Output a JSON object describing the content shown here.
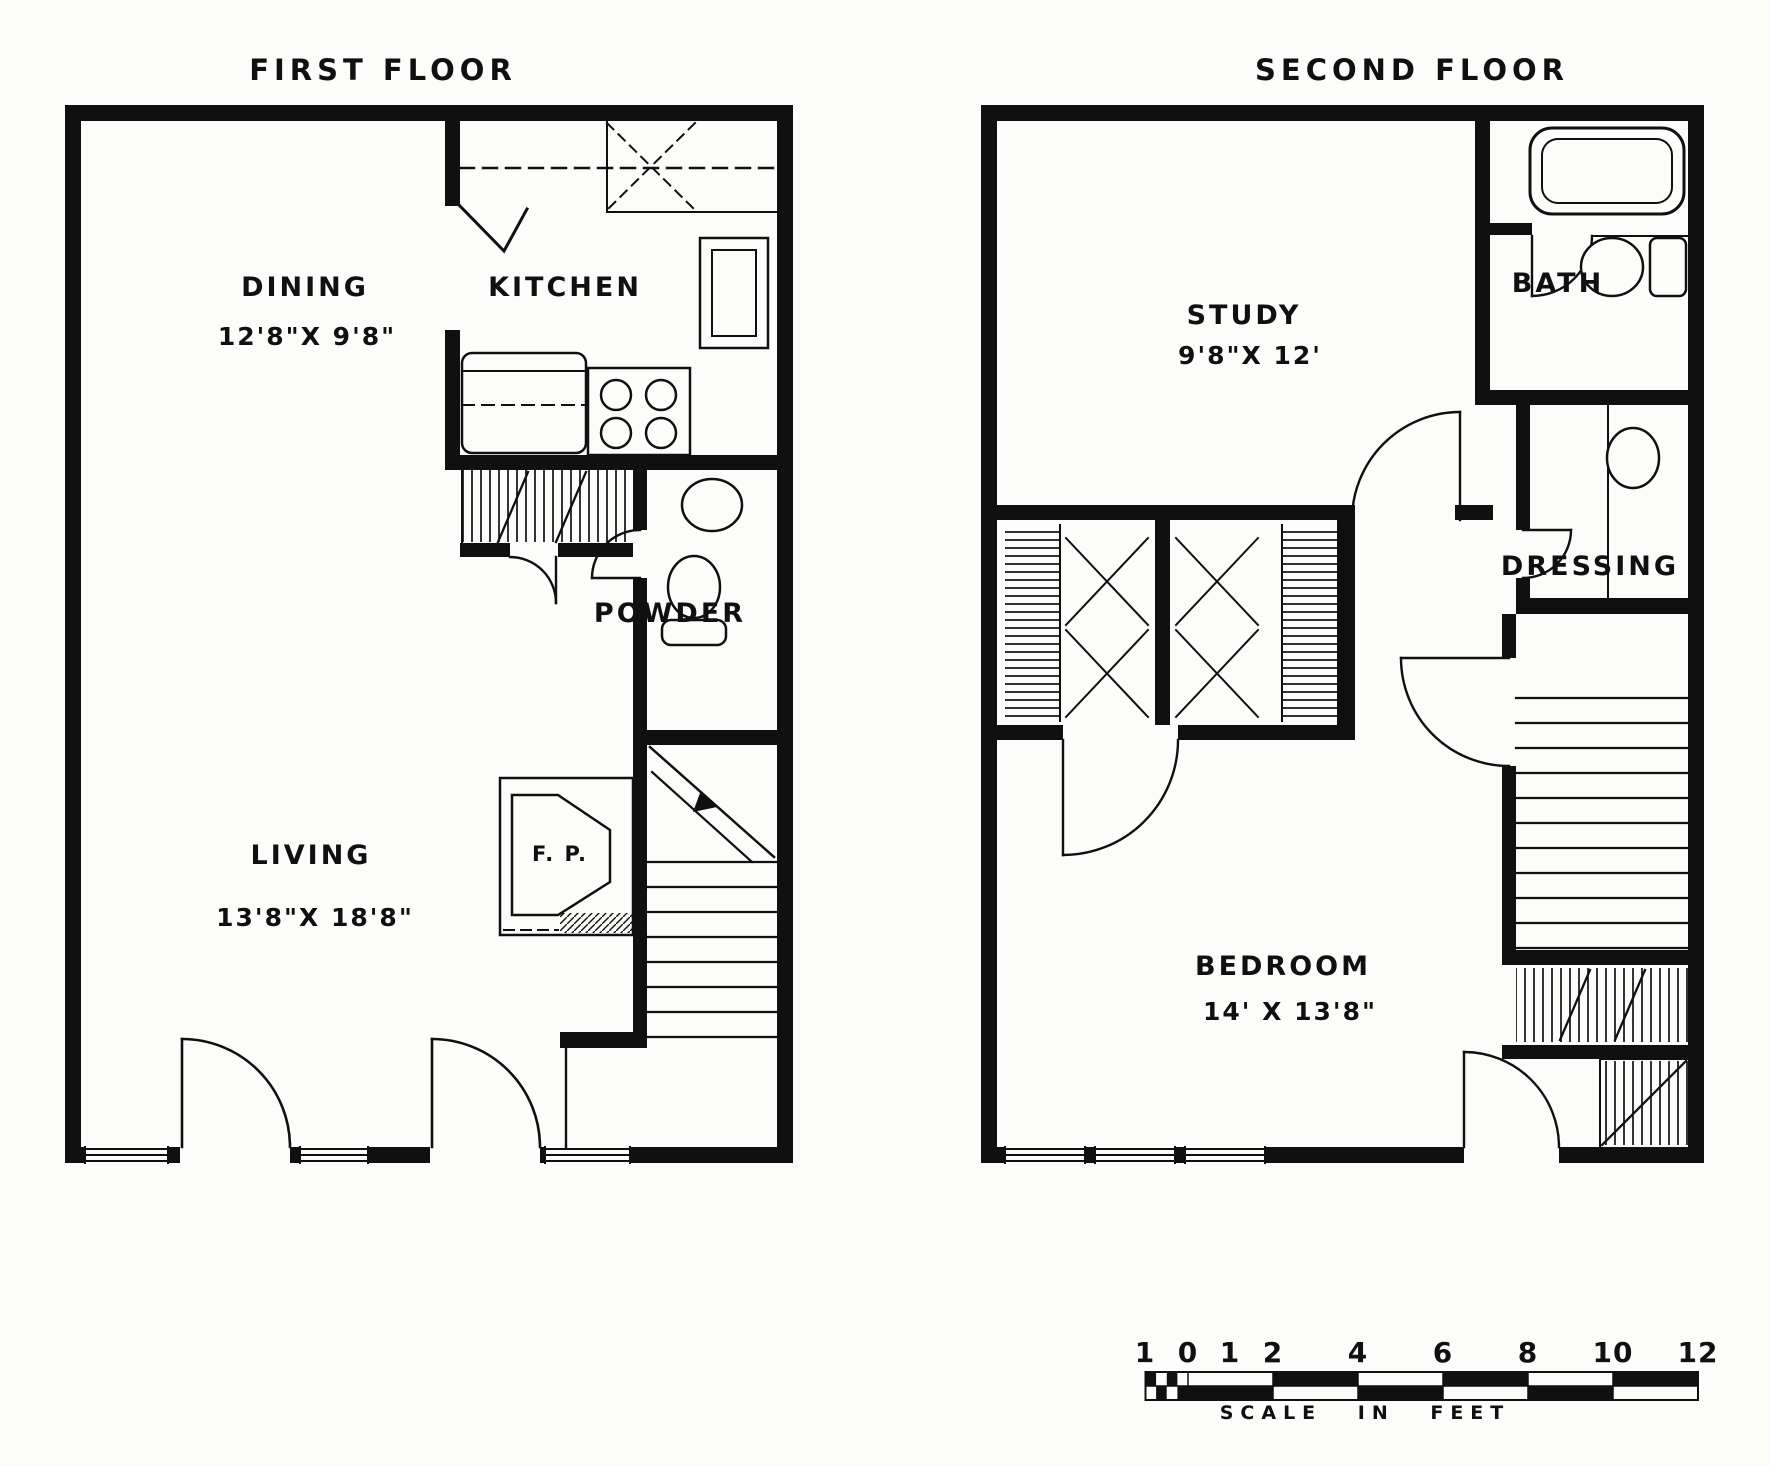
{
  "first_floor": {
    "title": "FIRST FLOOR",
    "rooms": {
      "dining": {
        "label": "DINING",
        "dims": "12'8\"X 9'8\""
      },
      "kitchen": {
        "label": "KITCHEN"
      },
      "powder": {
        "label": "POWDER"
      },
      "living": {
        "label": "LIVING",
        "dims": "13'8\"X 18'8\""
      },
      "fireplace": {
        "label": "F. P."
      }
    }
  },
  "second_floor": {
    "title": "SECOND FLOOR",
    "rooms": {
      "study": {
        "label": "STUDY",
        "dims": "9'8\"X 12'"
      },
      "bath": {
        "label": "BATH"
      },
      "dressing": {
        "label": "DRESSING"
      },
      "bedroom": {
        "label": "BEDROOM",
        "dims": "14' X 13'8\""
      }
    }
  },
  "scale_bar": {
    "ticks": [
      "1",
      "0",
      "1",
      "2",
      "4",
      "6",
      "8",
      "10",
      "12"
    ],
    "caption": "SCALE IN FEET"
  },
  "colors": {
    "ink": "#101010",
    "paper": "#fcfcfa"
  }
}
